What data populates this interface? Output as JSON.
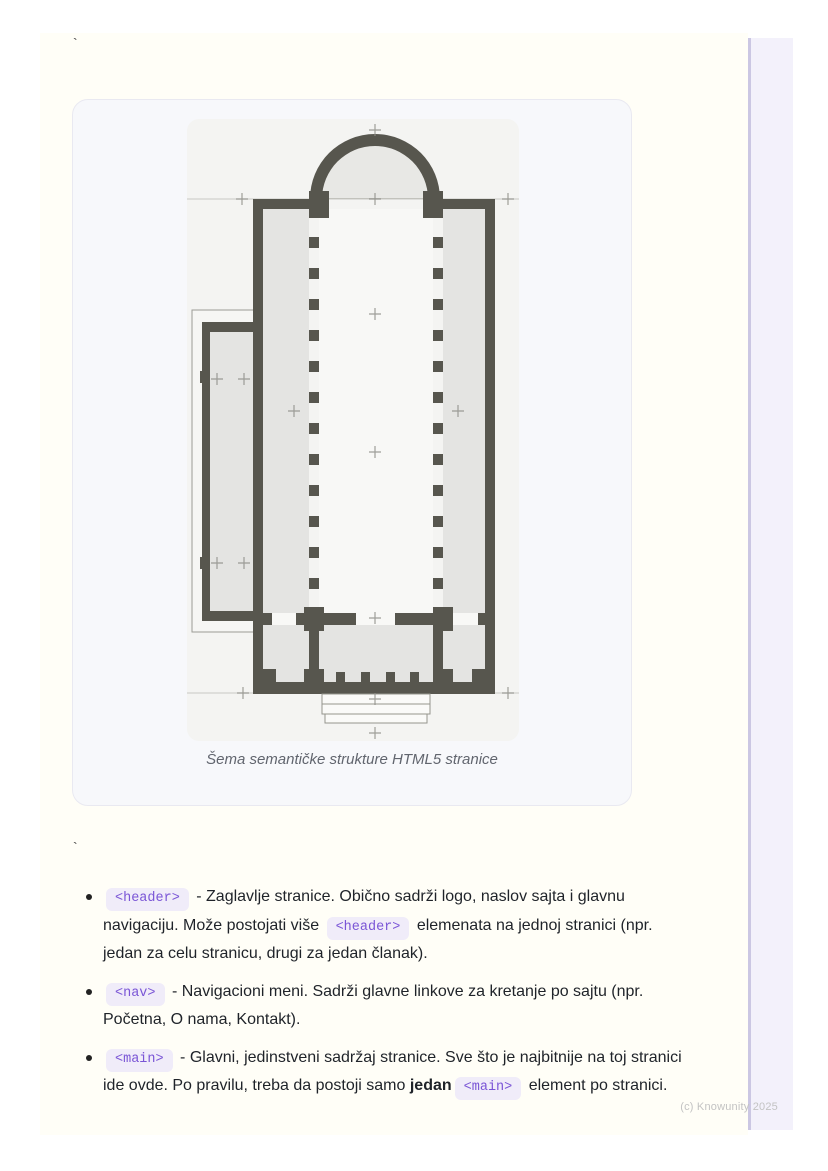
{
  "page": {
    "tick_top": "`",
    "tick_mid": "`",
    "watermark": "(c) Knowunity 2025"
  },
  "figure": {
    "caption": "Šema semantičke strukture HTML5 stranice",
    "image_name": "church-floor-plan"
  },
  "list": {
    "items": [
      {
        "segments": [
          {
            "type": "code",
            "text": "<header>"
          },
          {
            "type": "text",
            "text": " - Zaglavlje stranice. Obično sadrži logo, naslov sajta i glavnu navigaciju. Može postojati više "
          },
          {
            "type": "code",
            "text": "<header>"
          },
          {
            "type": "text",
            "text": " elemenata na jednoj stranici (npr. jedan za celu stranicu, drugi za jedan članak)."
          }
        ]
      },
      {
        "segments": [
          {
            "type": "code",
            "text": "<nav>"
          },
          {
            "type": "text",
            "text": " - Navigacioni meni. Sadrži glavne linkove za kretanje po sajtu (npr. Početna, O nama, Kontakt)."
          }
        ]
      },
      {
        "segments": [
          {
            "type": "code",
            "text": "<main>"
          },
          {
            "type": "text",
            "text": " - Glavni, jedinstveni sadržaj stranice. Sve što je najbitnije na toj stranici ide ovde. Po pravilu, treba da postoji samo "
          },
          {
            "type": "bold",
            "text": "jedan"
          },
          {
            "type": "code",
            "text": "<main>"
          },
          {
            "type": "text",
            "text": " element po stranici."
          }
        ]
      }
    ]
  },
  "colors": {
    "content_bg": "#fffef7",
    "card_bg": "#f7f8fb",
    "card_border": "#e9e9f1",
    "plan_bg": "#f4f4f2",
    "wall": "#57564e",
    "room": "#e4e4e2",
    "nave": "#f8f8f6",
    "dome_inner": "#e8e8e5",
    "code_bg": "#f0ecf9",
    "code_text": "#7a55d6",
    "text": "#1f2329",
    "caption": "#61656e",
    "watermark": "#c3c3c3",
    "strip_bg": "#f3f1fb",
    "strip_border": "#cbc7e3"
  }
}
